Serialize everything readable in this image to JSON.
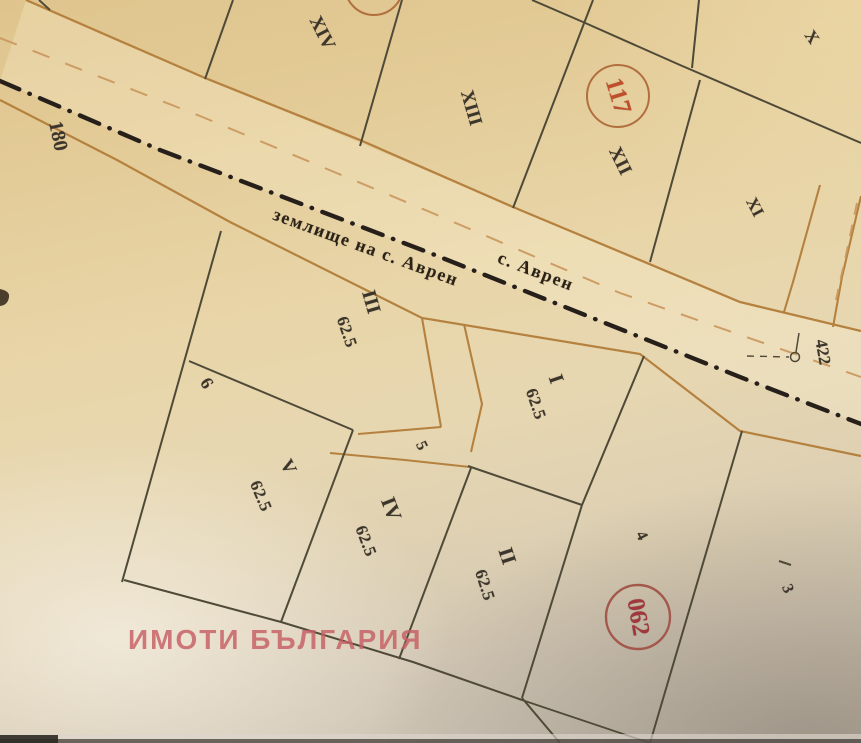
{
  "map": {
    "boundary_text": "землище на с. Аврен",
    "village_text": "с. Аврен",
    "circled_numbers": {
      "top": "117",
      "bottom": "062"
    },
    "parcels": {
      "xiv": "XIV",
      "xiii": "XIII",
      "xii": "XII",
      "xi": "XI",
      "x": "X",
      "iii": "III",
      "i": "I",
      "v": "V",
      "iv": "IV",
      "ii": "II"
    },
    "areas": {
      "iii": "62.5",
      "i": "62.5",
      "v": "62.5",
      "iv": "62.5",
      "ii": "62.5"
    },
    "numbers": {
      "n180": "180",
      "n422": "422",
      "n5": "5",
      "n6": "6",
      "n4": "4",
      "n3": "3"
    }
  },
  "watermark": {
    "text": "ИМОТИ БЪЛГАРИЯ",
    "color": "#c75f64"
  },
  "colors": {
    "paper": "#e6d3a4",
    "road_line": "#b5813f",
    "road_dash": "#c9965c",
    "parcel_line": "#4f4a38",
    "boundary_line": "#27201a",
    "circle_top_stroke": "#b26f3e",
    "circle_top_text": "#bf4f2c",
    "circle_bottom_stroke": "#a3584c",
    "circle_bottom_text": "#a0393d"
  }
}
